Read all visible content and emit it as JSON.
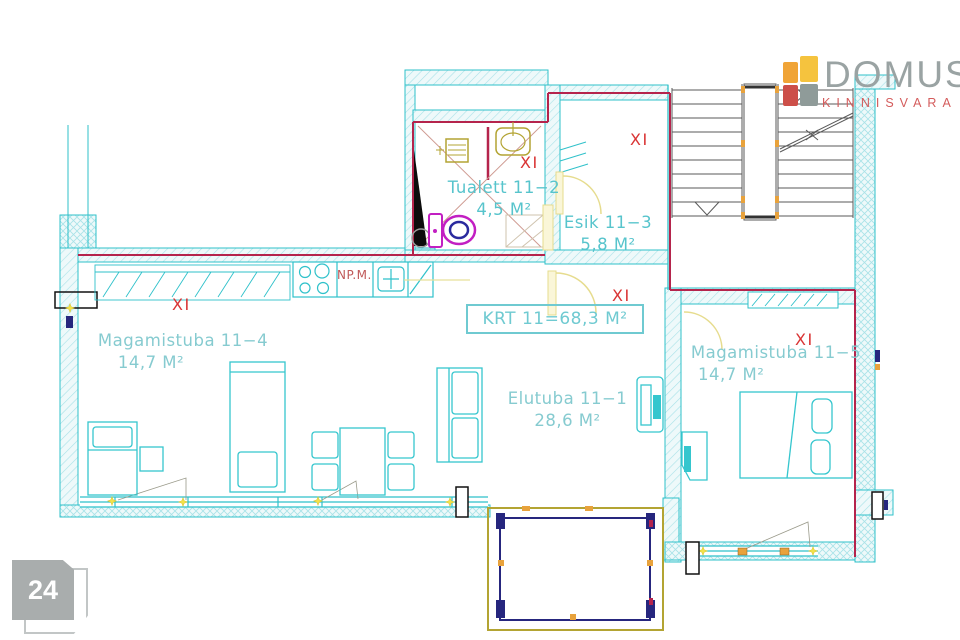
{
  "branding": {
    "name": "DOMUS",
    "subtitle": "KINNISVARA"
  },
  "page_badge": {
    "number": "24"
  },
  "plan": {
    "summary_label": "KRT 11=68,3 M²",
    "floor_marker": "XI",
    "kitchen_note": "NP.M.",
    "rooms": [
      {
        "id": "tualett",
        "name": "Tualett 11−2",
        "area": "4,5 M²"
      },
      {
        "id": "esik",
        "name": "Esik 11−3",
        "area": "5,8 M²"
      },
      {
        "id": "magamistuba-4",
        "name": "Magamistuba 11−4",
        "area": "14,7 M²"
      },
      {
        "id": "magamistuba-5",
        "name": "Magamistuba 11−5",
        "area": "14,7 M²"
      },
      {
        "id": "elutuba",
        "name": "Elutuba 11−1",
        "area": "28,6 M²"
      }
    ]
  },
  "colors": {
    "wall_line": "#2fc1ca",
    "apartment_boundary": "#b5244c",
    "floor_marker": "#d93434",
    "room_label": "#86cbd0",
    "fixture_olive": "#b3a433",
    "toilet_magenta": "#c21fc2",
    "door_yellow": "#e6dc8e",
    "accent_orange": "#e8a23c",
    "balcony_navy": "#26267e"
  }
}
